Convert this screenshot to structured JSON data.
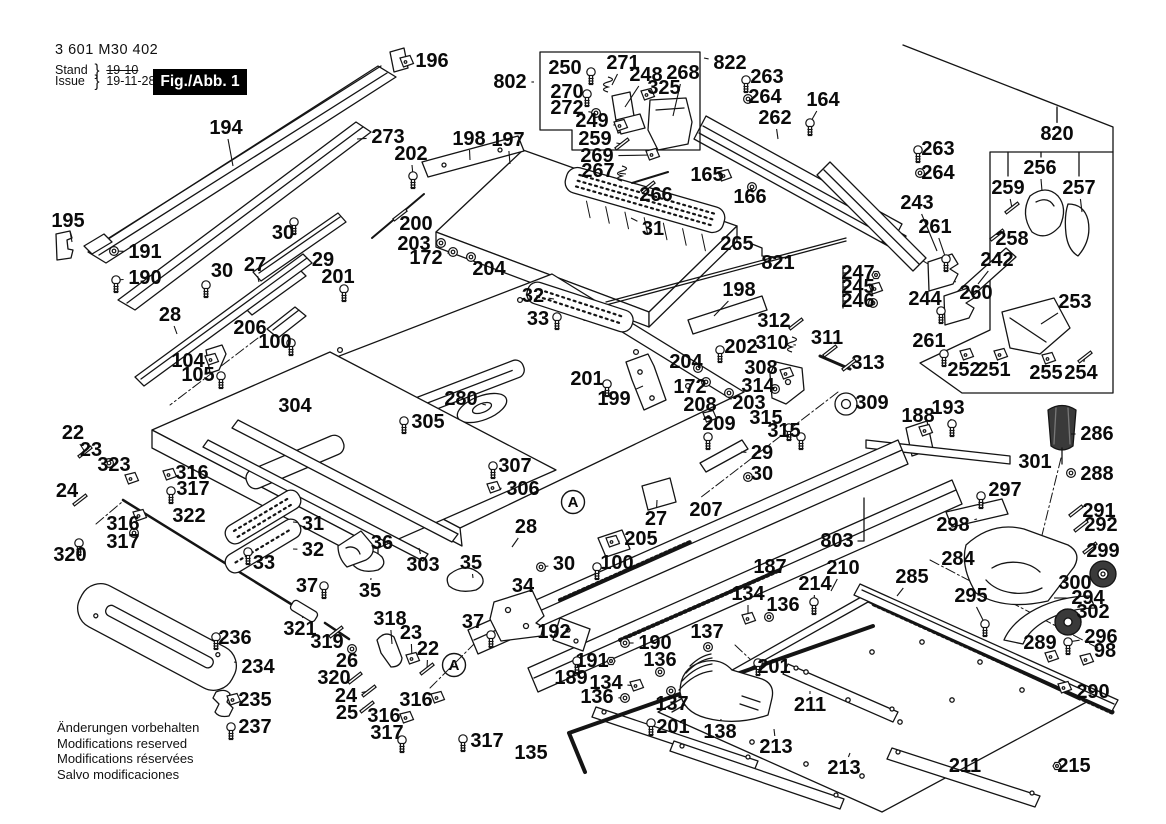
{
  "header": {
    "part_number": "3 601 M30 402",
    "stand_label": "Stand",
    "issue_label": "Issue",
    "brace": "}",
    "stand_value": "19-10",
    "issue_value": "19-11-28",
    "figure_label": "Fig./Abb. 1"
  },
  "footer": {
    "lines": [
      "Änderungen vorbehalten",
      "Modifications reserved",
      "Modifications réservées",
      "Salvo modificaciones"
    ]
  },
  "colors": {
    "ink": "#141414",
    "background": "#ffffff",
    "dark_fill": "#3a3a3a"
  },
  "figure": {
    "width": 1166,
    "height": 824,
    "detail_markers": [
      {
        "label": "A",
        "x": 454,
        "y": 665
      },
      {
        "label": "A",
        "x": 573,
        "y": 502
      }
    ],
    "callouts": [
      [
        "194",
        226,
        128,
        233,
        166,
        ""
      ],
      [
        "195",
        68,
        221,
        72,
        242,
        ""
      ],
      [
        "191",
        145,
        252,
        114,
        251,
        "w"
      ],
      [
        "190",
        145,
        278,
        116,
        280,
        "s"
      ],
      [
        "196",
        432,
        61,
        406,
        62,
        "b"
      ],
      [
        "273",
        388,
        137,
        357,
        139,
        ""
      ],
      [
        "202",
        411,
        154,
        413,
        176,
        "s"
      ],
      [
        "198",
        469,
        139,
        470,
        160,
        ""
      ],
      [
        "197",
        508,
        140,
        510,
        164,
        ""
      ],
      [
        "802",
        510,
        82,
        534,
        82,
        ""
      ],
      [
        "250",
        565,
        68,
        591,
        72,
        "s"
      ],
      [
        "271",
        623,
        63,
        612,
        85,
        "g"
      ],
      [
        "248",
        646,
        75,
        625,
        107,
        ""
      ],
      [
        "268",
        683,
        73,
        673,
        116,
        ""
      ],
      [
        "822",
        730,
        63,
        704,
        58,
        ""
      ],
      [
        "325",
        664,
        88,
        647,
        95,
        "b"
      ],
      [
        "263",
        767,
        77,
        746,
        80,
        "s"
      ],
      [
        "264",
        765,
        97,
        748,
        99,
        "w"
      ],
      [
        "164",
        823,
        100,
        810,
        123,
        "s"
      ],
      [
        "270",
        567,
        92,
        587,
        94,
        "s"
      ],
      [
        "272",
        567,
        108,
        596,
        113,
        "w"
      ],
      [
        "249",
        592,
        121,
        620,
        126,
        "b"
      ],
      [
        "262",
        775,
        118,
        778,
        139,
        ""
      ],
      [
        "259",
        595,
        139,
        622,
        144,
        "p"
      ],
      [
        "269",
        597,
        156,
        652,
        155,
        "b"
      ],
      [
        "267",
        598,
        171,
        626,
        174,
        "g"
      ],
      [
        "266",
        656,
        195,
        648,
        187,
        "p"
      ],
      [
        "165",
        707,
        175,
        724,
        176,
        "b"
      ],
      [
        "166",
        750,
        197,
        752,
        187,
        "w"
      ],
      [
        "263",
        938,
        149,
        918,
        150,
        "s"
      ],
      [
        "264",
        938,
        173,
        920,
        173,
        "w"
      ],
      [
        "820",
        1057,
        134,
        1057,
        108,
        ""
      ],
      [
        "243",
        917,
        203,
        937,
        251,
        ""
      ],
      [
        "261",
        935,
        227,
        946,
        259,
        "s"
      ],
      [
        "256",
        1040,
        168,
        1042,
        191,
        ""
      ],
      [
        "259",
        1008,
        188,
        1012,
        208,
        "p"
      ],
      [
        "257",
        1079,
        188,
        1082,
        212,
        ""
      ],
      [
        "258",
        1012,
        239,
        997,
        235,
        "p"
      ],
      [
        "242",
        997,
        260,
        978,
        284,
        ""
      ],
      [
        "260",
        976,
        293,
        954,
        281,
        ""
      ],
      [
        "244",
        925,
        299,
        941,
        311,
        "s"
      ],
      [
        "253",
        1075,
        302,
        1041,
        324,
        ""
      ],
      [
        "261",
        929,
        341,
        944,
        354,
        "s"
      ],
      [
        "252",
        964,
        370,
        966,
        355,
        "b"
      ],
      [
        "251",
        994,
        370,
        1000,
        355,
        "b"
      ],
      [
        "255",
        1046,
        373,
        1048,
        359,
        "b"
      ],
      [
        "254",
        1081,
        373,
        1085,
        357,
        "p"
      ],
      [
        "188",
        918,
        416,
        925,
        431,
        "b"
      ],
      [
        "193",
        948,
        408,
        952,
        424,
        "s"
      ],
      [
        "265",
        737,
        244,
        759,
        248,
        ""
      ],
      [
        "821",
        778,
        263,
        792,
        257,
        ""
      ],
      [
        "198",
        739,
        290,
        714,
        316,
        ""
      ],
      [
        "247",
        858,
        273,
        876,
        275,
        "n"
      ],
      [
        "245",
        858,
        287,
        875,
        289,
        "b"
      ],
      [
        "246",
        858,
        301,
        873,
        303,
        "w"
      ],
      [
        "312",
        774,
        321,
        796,
        324,
        "p"
      ],
      [
        "310",
        772,
        343,
        796,
        345,
        "g"
      ],
      [
        "311",
        827,
        338,
        830,
        351,
        "p"
      ],
      [
        "313",
        868,
        363,
        849,
        365,
        "p"
      ],
      [
        "202",
        741,
        347,
        720,
        350,
        "s"
      ],
      [
        "308",
        761,
        368,
        786,
        374,
        "b"
      ],
      [
        "314",
        758,
        386,
        775,
        389,
        "w"
      ],
      [
        "203",
        749,
        403,
        729,
        393,
        "w"
      ],
      [
        "208",
        700,
        405,
        709,
        417,
        "b"
      ],
      [
        "209",
        719,
        424,
        708,
        437,
        "s"
      ],
      [
        "315",
        766,
        418,
        789,
        428,
        "s"
      ],
      [
        "315",
        784,
        431,
        801,
        437,
        "s"
      ],
      [
        "309",
        872,
        403,
        849,
        404,
        ""
      ],
      [
        "172",
        690,
        387,
        706,
        382,
        "w"
      ],
      [
        "204",
        686,
        362,
        698,
        368,
        "w"
      ],
      [
        "201",
        587,
        379,
        607,
        384,
        "s"
      ],
      [
        "199",
        614,
        399,
        643,
        386,
        ""
      ],
      [
        "200",
        416,
        224,
        400,
        215,
        "p"
      ],
      [
        "203",
        414,
        244,
        441,
        243,
        "w"
      ],
      [
        "172",
        426,
        258,
        453,
        252,
        "w"
      ],
      [
        "204",
        489,
        269,
        471,
        257,
        "w"
      ],
      [
        "32",
        533,
        296,
        554,
        299,
        ""
      ],
      [
        "33",
        538,
        319,
        557,
        317,
        "s"
      ],
      [
        "31",
        653,
        229,
        631,
        218,
        ""
      ],
      [
        "280",
        461,
        399,
        486,
        405,
        ""
      ],
      [
        "305",
        428,
        422,
        404,
        421,
        "s"
      ],
      [
        "307",
        515,
        466,
        493,
        466,
        "s"
      ],
      [
        "306",
        523,
        489,
        493,
        488,
        "b"
      ],
      [
        "303",
        423,
        565,
        419,
        548,
        ""
      ],
      [
        "35",
        471,
        563,
        473,
        578,
        ""
      ],
      [
        "34",
        523,
        586,
        515,
        598,
        ""
      ],
      [
        "28",
        526,
        527,
        512,
        547,
        ""
      ],
      [
        "30",
        564,
        564,
        541,
        567,
        "w"
      ],
      [
        "205",
        641,
        539,
        612,
        542,
        "b"
      ],
      [
        "100",
        617,
        563,
        597,
        567,
        "s"
      ],
      [
        "27",
        656,
        519,
        657,
        500,
        ""
      ],
      [
        "207",
        706,
        510,
        697,
        522,
        ""
      ],
      [
        "187",
        770,
        567,
        772,
        556,
        ""
      ],
      [
        "803",
        837,
        541,
        856,
        541,
        ""
      ],
      [
        "210",
        843,
        568,
        831,
        591,
        ""
      ],
      [
        "214",
        815,
        584,
        814,
        602,
        "s"
      ],
      [
        "285",
        912,
        577,
        897,
        596,
        ""
      ],
      [
        "295",
        971,
        596,
        985,
        624,
        "s"
      ],
      [
        "284",
        958,
        559,
        980,
        560,
        ""
      ],
      [
        "300",
        1075,
        583,
        1094,
        578,
        ""
      ],
      [
        "294",
        1088,
        598,
        1054,
        598,
        ""
      ],
      [
        "302",
        1093,
        612,
        1076,
        620,
        ""
      ],
      [
        "289",
        1040,
        643,
        1051,
        657,
        "b"
      ],
      [
        "296",
        1101,
        637,
        1068,
        642,
        "s"
      ],
      [
        "98",
        1105,
        651,
        1086,
        660,
        "b"
      ],
      [
        "290",
        1093,
        692,
        1064,
        688,
        "b"
      ],
      [
        "211",
        965,
        766,
        946,
        765,
        ""
      ],
      [
        "215",
        1074,
        766,
        1057,
        766,
        "n"
      ],
      [
        "286",
        1097,
        434,
        1071,
        434,
        ""
      ],
      [
        "288",
        1097,
        474,
        1071,
        473,
        "w"
      ],
      [
        "301",
        1035,
        462,
        1013,
        462,
        ""
      ],
      [
        "297",
        1005,
        490,
        981,
        496,
        "s"
      ],
      [
        "291",
        1099,
        511,
        1076,
        511,
        "p"
      ],
      [
        "292",
        1101,
        525,
        1081,
        526,
        "p"
      ],
      [
        "298",
        953,
        525,
        977,
        519,
        ""
      ],
      [
        "299",
        1103,
        551,
        1090,
        548,
        "p"
      ],
      [
        "192",
        554,
        632,
        577,
        630,
        ""
      ],
      [
        "190",
        655,
        643,
        625,
        643,
        "w"
      ],
      [
        "191",
        592,
        661,
        611,
        661,
        "n"
      ],
      [
        "189",
        571,
        678,
        577,
        661,
        "s"
      ],
      [
        "134",
        606,
        683,
        636,
        686,
        "b"
      ],
      [
        "136",
        597,
        697,
        625,
        698,
        "w"
      ],
      [
        "201",
        673,
        727,
        651,
        723,
        "s"
      ],
      [
        "138",
        720,
        732,
        721,
        719,
        ""
      ],
      [
        "137",
        672,
        704,
        671,
        691,
        "w"
      ],
      [
        "136",
        660,
        660,
        660,
        672,
        "w"
      ],
      [
        "134",
        748,
        594,
        748,
        619,
        "b"
      ],
      [
        "136",
        783,
        605,
        769,
        617,
        "w"
      ],
      [
        "137",
        707,
        632,
        708,
        647,
        "w"
      ],
      [
        "201",
        774,
        667,
        758,
        663,
        "s"
      ],
      [
        "211",
        810,
        705,
        810,
        691,
        ""
      ],
      [
        "213",
        776,
        747,
        774,
        729,
        ""
      ],
      [
        "213",
        844,
        768,
        850,
        753,
        ""
      ],
      [
        "135",
        531,
        753,
        547,
        753,
        ""
      ],
      [
        "37",
        473,
        622,
        491,
        635,
        "s"
      ],
      [
        "318",
        390,
        619,
        392,
        644,
        ""
      ],
      [
        "23",
        411,
        633,
        412,
        659,
        "b"
      ],
      [
        "22",
        428,
        649,
        427,
        669,
        "p"
      ],
      [
        "26",
        347,
        661,
        352,
        649,
        "w"
      ],
      [
        "320",
        334,
        678,
        355,
        678,
        "p"
      ],
      [
        "24",
        346,
        696,
        369,
        691,
        "p"
      ],
      [
        "25",
        347,
        713,
        367,
        707,
        "p"
      ],
      [
        "316",
        416,
        700,
        437,
        698,
        "b"
      ],
      [
        "316",
        384,
        716,
        406,
        718,
        "b"
      ],
      [
        "317",
        387,
        733,
        402,
        740,
        "s"
      ],
      [
        "317",
        487,
        741,
        463,
        739,
        "s"
      ],
      [
        "36",
        382,
        543,
        366,
        548,
        ""
      ],
      [
        "35",
        370,
        591,
        371,
        578,
        ""
      ],
      [
        "37",
        307,
        586,
        324,
        586,
        "s"
      ],
      [
        "31",
        313,
        524,
        293,
        522,
        ""
      ],
      [
        "32",
        313,
        550,
        293,
        549,
        ""
      ],
      [
        "33",
        264,
        563,
        248,
        552,
        "s"
      ],
      [
        "322",
        189,
        516,
        202,
        528,
        ""
      ],
      [
        "320",
        70,
        555,
        79,
        543,
        "s"
      ],
      [
        "316",
        123,
        524,
        139,
        516,
        "b"
      ],
      [
        "317",
        123,
        542,
        134,
        533,
        "w"
      ],
      [
        "22",
        73,
        433,
        85,
        452,
        "p"
      ],
      [
        "23",
        91,
        450,
        109,
        463,
        "w"
      ],
      [
        "323",
        114,
        465,
        131,
        479,
        "b"
      ],
      [
        "24",
        67,
        491,
        80,
        500,
        "p"
      ],
      [
        "316",
        192,
        473,
        169,
        475,
        "b"
      ],
      [
        "317",
        193,
        489,
        171,
        491,
        "s"
      ],
      [
        "104",
        188,
        361,
        211,
        360,
        "b"
      ],
      [
        "105",
        198,
        375,
        221,
        376,
        "s"
      ],
      [
        "206",
        250,
        328,
        271,
        330,
        ""
      ],
      [
        "100",
        275,
        342,
        291,
        343,
        "s"
      ],
      [
        "304",
        295,
        406,
        298,
        414,
        ""
      ],
      [
        "28",
        170,
        315,
        177,
        334,
        ""
      ],
      [
        "27",
        255,
        265,
        259,
        282,
        ""
      ],
      [
        "29",
        323,
        260,
        313,
        250,
        ""
      ],
      [
        "30",
        283,
        233,
        294,
        222,
        "s"
      ],
      [
        "201",
        338,
        277,
        344,
        289,
        "s"
      ],
      [
        "30",
        222,
        271,
        206,
        285,
        "s"
      ],
      [
        "29",
        762,
        453,
        741,
        452,
        ""
      ],
      [
        "30",
        762,
        474,
        748,
        477,
        "w"
      ],
      [
        "236",
        235,
        638,
        216,
        637,
        "s"
      ],
      [
        "234",
        258,
        667,
        234,
        662,
        ""
      ],
      [
        "235",
        255,
        700,
        233,
        700,
        "b"
      ],
      [
        "237",
        255,
        727,
        231,
        727,
        "s"
      ],
      [
        "321",
        300,
        629,
        303,
        616,
        ""
      ],
      [
        "319",
        327,
        642,
        336,
        632,
        "p"
      ]
    ]
  }
}
